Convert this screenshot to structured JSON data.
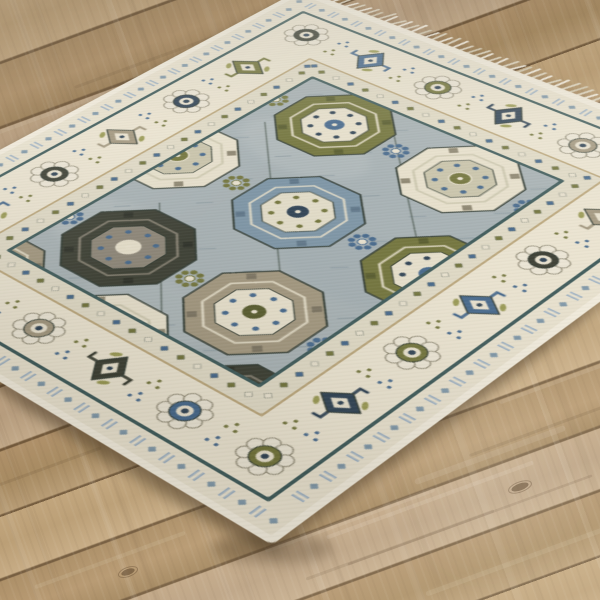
{
  "scene": {
    "type": "product-photo",
    "description": "Angled photo of a gray, ivory, blue and olive Oriental-style medallion area rug with white fringe, lying on light oak wood plank flooring",
    "canvas": {
      "width": 600,
      "height": 600
    }
  },
  "floor": {
    "plank_angle_deg": -20,
    "colors": {
      "base": "#b79a71",
      "plank_light": "#c7ab83",
      "plank_mid": "#b5966d",
      "plank_gray": "#c0a584",
      "plank_dark": "#a2855c",
      "seam": "#6f5638"
    },
    "streaks": [
      {
        "x": 350,
        "y": 520,
        "len": 180,
        "w": 5,
        "o": 0.1,
        "tone": "light"
      },
      {
        "x": 430,
        "y": 500,
        "len": 220,
        "w": 4,
        "o": 0.12,
        "tone": "light"
      },
      {
        "x": 490,
        "y": 455,
        "len": 160,
        "w": 6,
        "o": 0.1,
        "tone": "light"
      },
      {
        "x": 520,
        "y": 560,
        "len": 200,
        "w": 5,
        "o": 0.09,
        "tone": "light"
      },
      {
        "x": 556,
        "y": 382,
        "len": 120,
        "w": 4,
        "o": 0.1,
        "tone": "light"
      },
      {
        "x": 400,
        "y": 545,
        "len": 200,
        "w": 3,
        "o": 0.1,
        "tone": "dark"
      },
      {
        "x": 470,
        "y": 520,
        "len": 260,
        "w": 2.5,
        "o": 0.12,
        "tone": "dark"
      },
      {
        "x": 540,
        "y": 430,
        "len": 150,
        "w": 3,
        "o": 0.1,
        "tone": "dark"
      },
      {
        "x": 60,
        "y": 110,
        "len": 140,
        "w": 4,
        "o": 0.08,
        "tone": "light"
      },
      {
        "x": 150,
        "y": 60,
        "len": 160,
        "w": 3,
        "o": 0.1,
        "tone": "dark"
      },
      {
        "x": 230,
        "y": 40,
        "len": 120,
        "w": 2.5,
        "o": 0.1,
        "tone": "dark"
      },
      {
        "x": 40,
        "y": 470,
        "len": 130,
        "w": 3,
        "o": 0.1,
        "tone": "dark"
      },
      {
        "x": 110,
        "y": 560,
        "len": 160,
        "w": 4,
        "o": 0.09,
        "tone": "light"
      }
    ],
    "knots": [
      {
        "x": 128,
        "y": 572,
        "rx": 7,
        "ry": 3
      },
      {
        "x": 520,
        "y": 487,
        "rx": 9,
        "ry": 3.5
      }
    ]
  },
  "rug": {
    "style": "Oriental Oushak-style medallion rug",
    "local_size": {
      "width": 470,
      "height": 560
    },
    "corners_screen": {
      "top": [
        300,
        -10
      ],
      "right": [
        775,
        172
      ],
      "bottom": [
        272,
        545
      ],
      "left": [
        -205,
        259
      ]
    },
    "matrix3d": "matrix3d(0.75936,0.33147,0,-0.00032424,-0.84143,0.40409,0,-0.00029445,0,0,1,0,300,-10,0,1)",
    "colors": {
      "binding": "#f2ecdd",
      "guard_bg": "#e9e2cf",
      "guard_blue": "#9db1c4",
      "guard_blue2": "#7f97a8",
      "teal": "#3e5a5a",
      "major_bg": "#ebe4d1",
      "tan": "#bca87e",
      "inner_bg": "#e0dac6",
      "field": "#a7b1b4",
      "ivory": "#e9e2cf",
      "slate": "#46688c",
      "steel": "#7d95a6",
      "navy": "#2f4254",
      "olive": "#72743c",
      "olive_dark": "#575b2d",
      "olive_light": "#9a9a55",
      "charcoal": "#3b3e33",
      "taupe": "#a2977f",
      "taupe_dark": "#7c7462",
      "outline": "#2e3830"
    },
    "layers": [
      {
        "inset": 0,
        "fill": "binding",
        "name": "edge-binding"
      },
      {
        "inset": 6,
        "fill": "guard_bg",
        "name": "outer-guard-band"
      },
      {
        "inset": 28,
        "fill": "teal",
        "name": "guard-stripe"
      },
      {
        "inset": 31,
        "fill": "major_bg",
        "name": "major-border"
      },
      {
        "inset": 88,
        "fill": "tan",
        "name": "tan-stripe"
      },
      {
        "inset": 90,
        "fill": "inner_bg",
        "name": "inner-guard-band"
      },
      {
        "inset": 110,
        "fill": "teal",
        "name": "inner-stripe"
      },
      {
        "inset": 113,
        "fill": "field",
        "name": "field"
      }
    ],
    "fringe": {
      "edge": "far short end",
      "count": 64,
      "step": 7.3,
      "len": 14,
      "colors": [
        "#f4efe2",
        "#e2dbc8"
      ]
    },
    "major_border": {
      "motif_cycle": [
        "charcoal",
        "slate",
        "olive",
        "navy",
        "taupe"
      ],
      "h_count": 6,
      "v_count": 7
    },
    "field": {
      "rect": [
        113,
        113,
        244,
        334
      ],
      "mottle": [
        {
          "x": 180,
          "y": 200,
          "rx": 60,
          "ry": 34,
          "c": "#bcc3c4",
          "o": 0.35
        },
        {
          "x": 300,
          "y": 160,
          "rx": 48,
          "ry": 30,
          "c": "#93a1a8",
          "o": 0.3
        },
        {
          "x": 150,
          "y": 380,
          "rx": 55,
          "ry": 36,
          "c": "#c0c6c6",
          "o": 0.3
        },
        {
          "x": 320,
          "y": 300,
          "rx": 70,
          "ry": 40,
          "c": "#9aa8ae",
          "o": 0.28
        },
        {
          "x": 240,
          "y": 430,
          "rx": 60,
          "ry": 30,
          "c": "#b7bfc0",
          "o": 0.3
        }
      ],
      "runners": [
        {
          "x1": 130,
          "y1": 190,
          "x2": 300,
          "y2": 360
        },
        {
          "x1": 200,
          "y1": 120,
          "x2": 345,
          "y2": 262
        },
        {
          "x1": 150,
          "y1": 330,
          "x2": 260,
          "y2": 440
        }
      ],
      "medallions": [
        {
          "x": 175,
          "y": 158,
          "s": 100,
          "cw": "olive"
        },
        {
          "x": 299,
          "y": 158,
          "s": 100,
          "cw": "ivory"
        },
        {
          "x": 113,
          "y": 272,
          "s": 102,
          "cw": "ivory"
        },
        {
          "x": 237,
          "y": 272,
          "s": 104,
          "cw": "slate"
        },
        {
          "x": 361,
          "y": 272,
          "s": 102,
          "cw": "olive"
        },
        {
          "x": 175,
          "y": 388,
          "s": 106,
          "cw": "charcoal"
        },
        {
          "x": 299,
          "y": 388,
          "s": 106,
          "cw": "taupe"
        },
        {
          "x": 113,
          "y": 478,
          "s": 100,
          "cw": "taupe"
        },
        {
          "x": 237,
          "y": 478,
          "s": 102,
          "cw": "ivory"
        },
        {
          "x": 361,
          "y": 478,
          "s": 100,
          "cw": "charcoal"
        }
      ],
      "florettes": [
        {
          "x": 237,
          "y": 158,
          "c": "slate"
        },
        {
          "x": 113,
          "y": 158,
          "c": "olive"
        },
        {
          "x": 361,
          "y": 158,
          "c": "slate"
        },
        {
          "x": 175,
          "y": 272,
          "c": "olive"
        },
        {
          "x": 299,
          "y": 272,
          "c": "slate"
        },
        {
          "x": 113,
          "y": 388,
          "c": "slate"
        },
        {
          "x": 237,
          "y": 388,
          "c": "olive"
        },
        {
          "x": 361,
          "y": 388,
          "c": "slate"
        },
        {
          "x": 175,
          "y": 478,
          "c": "olive"
        },
        {
          "x": 299,
          "y": 478,
          "c": "slate"
        }
      ]
    },
    "medallion_colorways": {
      "ivory": {
        "body": "#e7e0cc",
        "inner": "#c9c4ab",
        "center": "#72743c",
        "dots": "#46688c",
        "arms": "#8d8671"
      },
      "olive": {
        "body": "#72743c",
        "inner": "#e7e0cc",
        "center": "#46688c",
        "dots": "#2f4254",
        "arms": "#575b2d"
      },
      "slate": {
        "body": "#7d95a6",
        "inner": "#e2dcc8",
        "center": "#2f4254",
        "dots": "#72743c",
        "arms": "#5f7689"
      },
      "charcoal": {
        "body": "#3b3e33",
        "inner": "#8d8678",
        "center": "#e7e0cc",
        "dots": "#46688c",
        "arms": "#2c2f27"
      },
      "taupe": {
        "body": "#a2977f",
        "inner": "#e7e0cc",
        "center": "#575b2d",
        "dots": "#46688c",
        "arms": "#7c7462"
      }
    },
    "shadows": [
      {
        "x": 140,
        "y": 468,
        "rx": 170,
        "ry": 14,
        "rot": 31,
        "o": 0.28
      },
      {
        "x": 436,
        "y": 420,
        "rx": 190,
        "ry": 14,
        "rot": -37,
        "o": 0.26
      },
      {
        "x": 272,
        "y": 548,
        "rx": 60,
        "ry": 16,
        "rot": 0,
        "o": 0.3
      }
    ],
    "texture_seed": 7
  }
}
